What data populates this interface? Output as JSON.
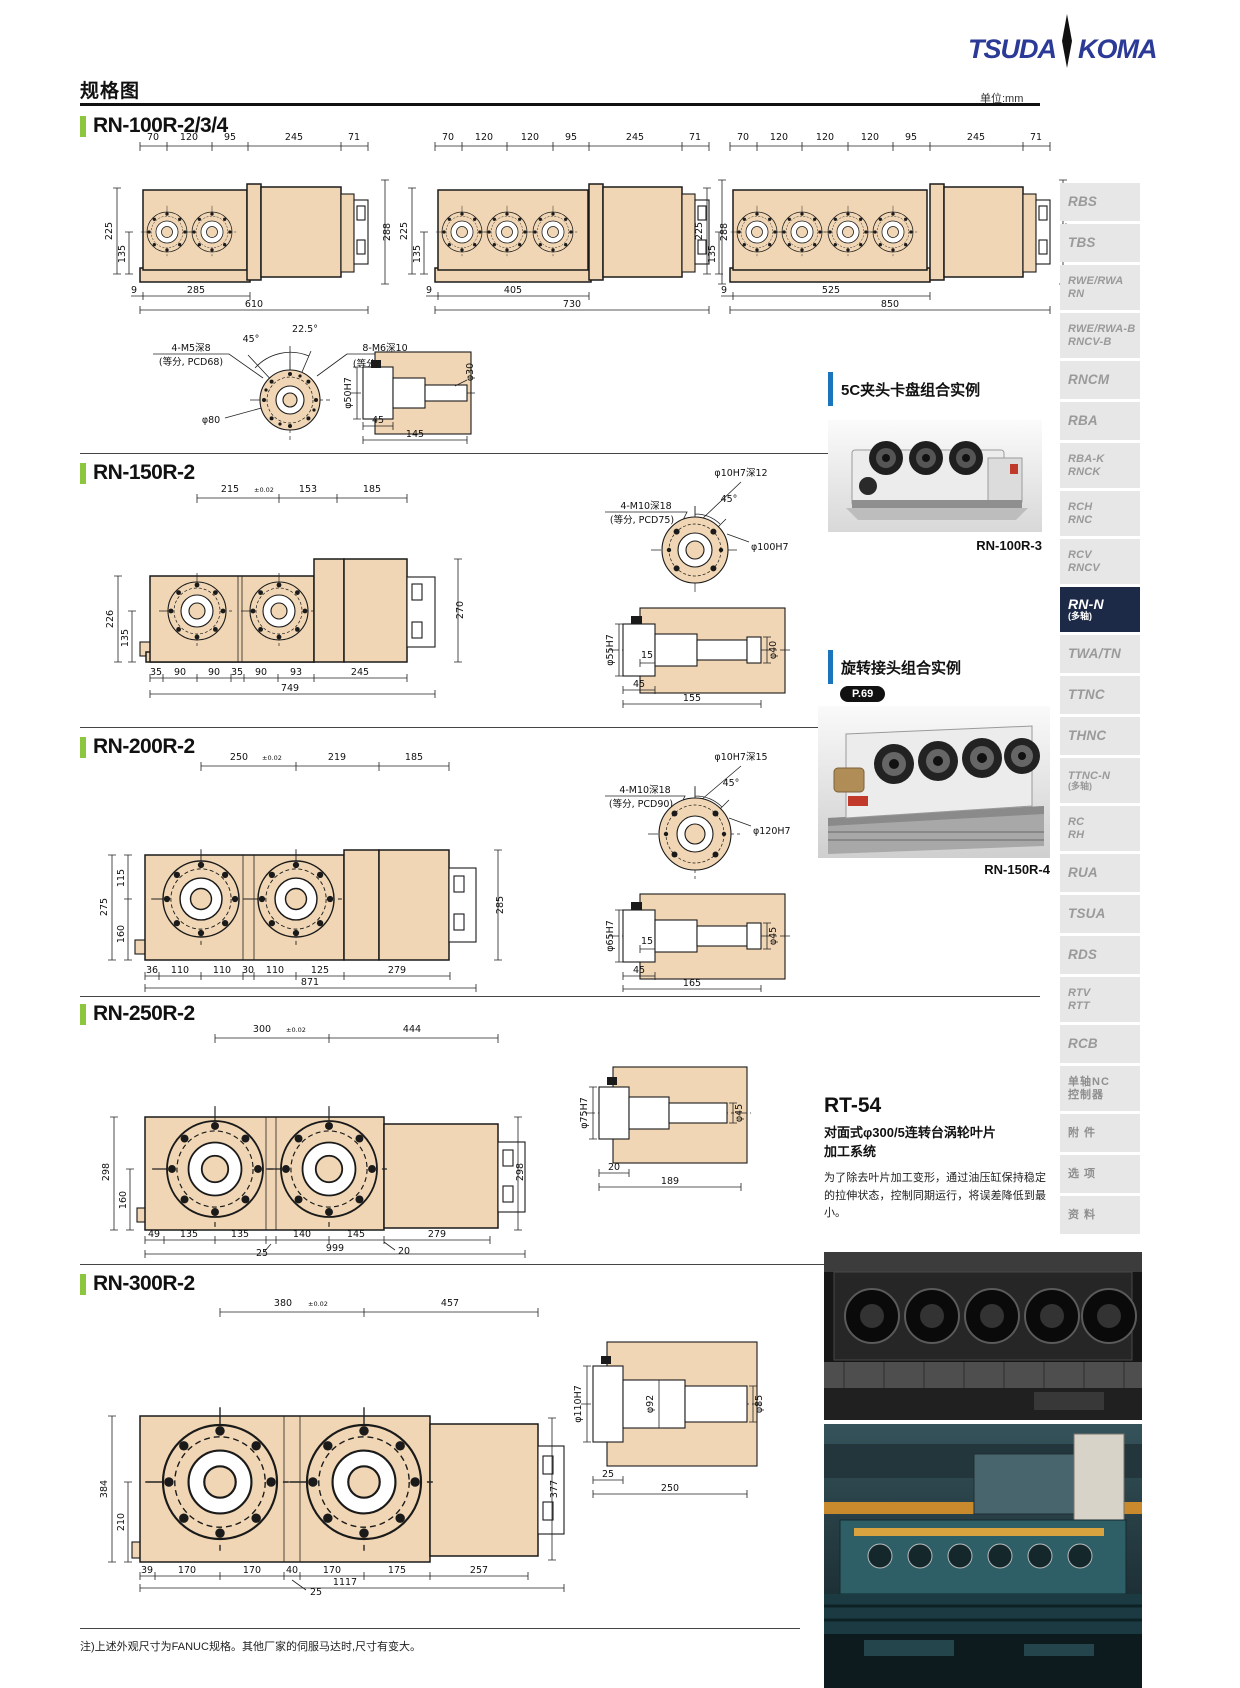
{
  "header": {
    "title": "规格图",
    "unit": "单位:mm",
    "logo": {
      "left": "TSUDA",
      "right": "KOMA"
    }
  },
  "s100": {
    "title": "RN-100R-2/3/4",
    "d2": {
      "top": [
        "70",
        "120",
        "95",
        "245",
        "71"
      ],
      "left": "225",
      "left2": "135",
      "right": "288",
      "b1": "9",
      "b2": "285",
      "b3": "610"
    },
    "d3": {
      "top": [
        "70",
        "120",
        "120",
        "95",
        "245",
        "71"
      ],
      "left": "225",
      "left2": "135",
      "right": "288",
      "b1": "9",
      "b2": "405",
      "b3": "730"
    },
    "d4": {
      "top": [
        "70",
        "120",
        "120",
        "120",
        "95",
        "245",
        "71"
      ],
      "left": "225",
      "left2": "135",
      "right": "288",
      "b1": "9",
      "b2": "525",
      "b3": "850"
    },
    "flange": {
      "tl1": "4-M5深8",
      "tl2": "(等分, PCD68)",
      "a1": "45°",
      "a2": "22.5°",
      "tr1": "8-M6深10",
      "tr2": "(等分, PCD68)",
      "dia": "φ80"
    },
    "shaft": {
      "bore": "φ50H7",
      "w1": "45",
      "w2": "145",
      "tip": "φ30"
    }
  },
  "s150": {
    "title": "RN-150R-2",
    "top": [
      "215",
      "153",
      "185"
    ],
    "tol": "±0.02",
    "left1": "226",
    "left2": "135",
    "right": "270",
    "bot": [
      "35",
      "90",
      "90",
      "35",
      "90",
      "93",
      "245"
    ],
    "total": "749",
    "flange": {
      "tl1": "4-M10深18",
      "tl2": "(等分, PCD75)",
      "tr": "φ10H7深12",
      "a": "45°",
      "dia": "φ100H7"
    },
    "shaft": {
      "bore": "φ55H7",
      "s1": "15",
      "tip": "φ40",
      "w1": "45",
      "w2": "155"
    }
  },
  "s200": {
    "title": "RN-200R-2",
    "top": [
      "250",
      "219",
      "185"
    ],
    "tol": "±0.02",
    "left1": "275",
    "left2": "115",
    "left3": "160",
    "right": "285",
    "bot": [
      "36",
      "110",
      "110",
      "30",
      "110",
      "125",
      "279"
    ],
    "total": "871",
    "flange": {
      "tl1": "4-M10深18",
      "tl2": "(等分, PCD90)",
      "tr": "φ10H7深15",
      "a": "45°",
      "dia": "φ120H7"
    },
    "shaft": {
      "bore": "φ65H7",
      "s1": "15",
      "tip": "φ45",
      "w1": "45",
      "w2": "165"
    }
  },
  "s250": {
    "title": "RN-250R-2",
    "top": [
      "300",
      "444"
    ],
    "tol": "±0.02",
    "left1": "298",
    "left2": "160",
    "right": "298",
    "bot": [
      "49",
      "135",
      "135",
      "140",
      "145"
    ],
    "gap": "25",
    "lead": "20",
    "motor": "279",
    "total": "999",
    "shaft": {
      "bore": "φ75H7",
      "w1": "20",
      "w2": "189",
      "tip": "φ45"
    }
  },
  "s300": {
    "title": "RN-300R-2",
    "top": [
      "380",
      "457"
    ],
    "tol": "±0.02",
    "left1": "384",
    "left2": "210",
    "right": "377",
    "bot": [
      "39",
      "170",
      "170",
      "40",
      "170",
      "175",
      "257"
    ],
    "gap": "25",
    "total": "1117",
    "shaft": {
      "bore": "φ110H7",
      "mid": "φ92",
      "tip": "φ85",
      "w1": "25",
      "w2": "250"
    }
  },
  "aside": {
    "ex1": {
      "heading": "5C夹头卡盘组合实例",
      "caption": "RN-100R-3"
    },
    "ex2": {
      "heading": "旋转接头组合实例",
      "badge": "P.69",
      "caption": "RN-150R-4"
    },
    "rt54": {
      "title": "RT-54",
      "sub1": "对面式φ300/5连转台涡轮叶片",
      "sub2": "加工系统",
      "body": "为了除去叶片加工变形，通过油压缸保持稳定的拉伸状态，控制同期运行，将误差降低到最小。"
    }
  },
  "sidebar": {
    "items": [
      {
        "l": "RBS"
      },
      {
        "l": "TBS"
      },
      {
        "l": "RWE/RWA",
        "l2": "RN"
      },
      {
        "l": "RWE/RWA-B",
        "l2": "RNCV-B"
      },
      {
        "l": "RNCM"
      },
      {
        "l": "RBA"
      },
      {
        "l": "RBA-K",
        "l2": "RNCK"
      },
      {
        "l": "RCH",
        "l2": "RNC"
      },
      {
        "l": "RCV",
        "l2": "RNCV"
      },
      {
        "l": "RN-N",
        "l2": "(多轴)"
      },
      {
        "l": "TWA/TN"
      },
      {
        "l": "TTNC"
      },
      {
        "l": "THNC"
      },
      {
        "l": "TTNC-N",
        "l2": "(多轴)"
      },
      {
        "l": "RC",
        "l2": "RH"
      },
      {
        "l": "RUA"
      },
      {
        "l": "TSUA"
      },
      {
        "l": "RDS"
      },
      {
        "l": "RTV",
        "l2": "RTT"
      },
      {
        "l": "RCB"
      },
      {
        "l": "单轴NC",
        "l2": "控制器"
      },
      {
        "l": "附 件"
      },
      {
        "l": "选 项"
      },
      {
        "l": "资 料"
      }
    ]
  },
  "footer": {
    "note": "注)上述外观尺寸为FANUC规格。其他厂家的伺服马达时,尺寸有变大。"
  }
}
